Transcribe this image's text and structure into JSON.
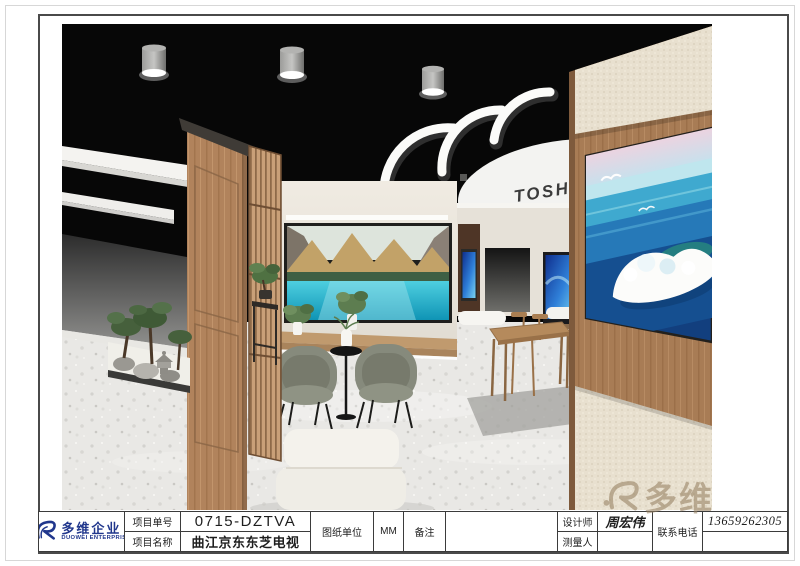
{
  "sheet": {
    "company": {
      "name_cn": "多维企业",
      "name_en": "DUOWEI ENTERPRISE"
    },
    "title_block": {
      "project_no_label": "项目单号",
      "project_no": "0715-DZTVA",
      "project_name_label": "项目名称",
      "project_name": "曲江京东东芝电视",
      "drawing_unit_label": "图纸单位",
      "drawing_unit": "MM",
      "remark_label": "备注",
      "remark": "",
      "designer_label": "设计师",
      "designer_name": "周宏伟",
      "surveyor_label": "测量人",
      "surveyor_name": "",
      "phone_label": "联系电话",
      "phone_number": "13659262305"
    },
    "watermark_text": "多维",
    "render": {
      "ceiling_brand": "TOSHIBA"
    },
    "colors": {
      "brand_blue": "#20368c",
      "watermark_tan": "#967f61",
      "ceiling_black": "#070707",
      "wood": "#ad7f58",
      "floor": "#e9e8e5",
      "lake_teal": "#2fb9d4"
    }
  }
}
